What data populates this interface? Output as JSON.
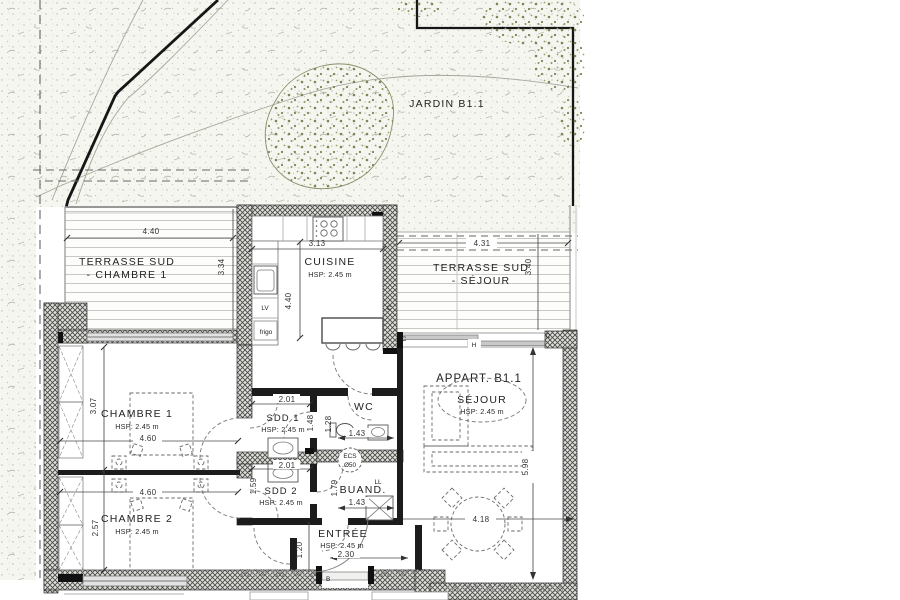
{
  "garden": {
    "label": "JARDIN B1.1"
  },
  "apartment": {
    "label": "APPART. B1.1"
  },
  "terraces": {
    "chambre1": {
      "line1": "TERRASSE SUD",
      "line2": "- CHAMBRE 1",
      "width": "4.40",
      "depth": "3.34"
    },
    "sejour": {
      "line1": "TERRASSE SUD",
      "line2": "- SÉJOUR",
      "width": "4.31",
      "depth": "3.40"
    }
  },
  "rooms": {
    "cuisine": {
      "name": "CUISINE",
      "hsp": "HSP: 2.45 m",
      "width": "3.13",
      "depth": "4.40"
    },
    "chambre1": {
      "name": "CHAMBRE 1",
      "hsp": "HSP: 2.45 m",
      "width": "4.60",
      "depth": "3.07"
    },
    "chambre2": {
      "name": "CHAMBRE 2",
      "hsp": "HSP: 2.45 m",
      "width": "4.60",
      "depth": "2.57"
    },
    "sdd1": {
      "name": "SDD 1",
      "hsp": "HSP: 2.45 m",
      "width": "2.01",
      "depth": "1.48"
    },
    "sdd2": {
      "name": "SDD 2",
      "hsp": "HSP: 2.45 m",
      "width": "2.01",
      "depth": "1.59"
    },
    "wc": {
      "name": "WC",
      "width": "1.43",
      "depth": "1.28"
    },
    "buanderie": {
      "name": "BUAND.",
      "width": "1.43",
      "depth": "1.79"
    },
    "entree": {
      "name": "ENTRÉE",
      "hsp": "HSP: 2.45 m",
      "width": "2.30",
      "depth": "1.20"
    },
    "sejour": {
      "name": "SÉJOUR",
      "hsp": "HSP: 2.45 m",
      "table_width": "4.18",
      "depth": "5.98"
    }
  },
  "equipment": {
    "ecs": "ECS",
    "ecs_diameter": "Ø50",
    "lv": "LV",
    "frigo": "frigo",
    "ll": "LL"
  },
  "door_labels": {
    "entrance": "B",
    "type_c": "C",
    "slider": "H"
  },
  "colors": {
    "tree_green": "#7d8455",
    "wall_dark": "#1c1c1c",
    "dim_gray": "#4a4a4a"
  }
}
